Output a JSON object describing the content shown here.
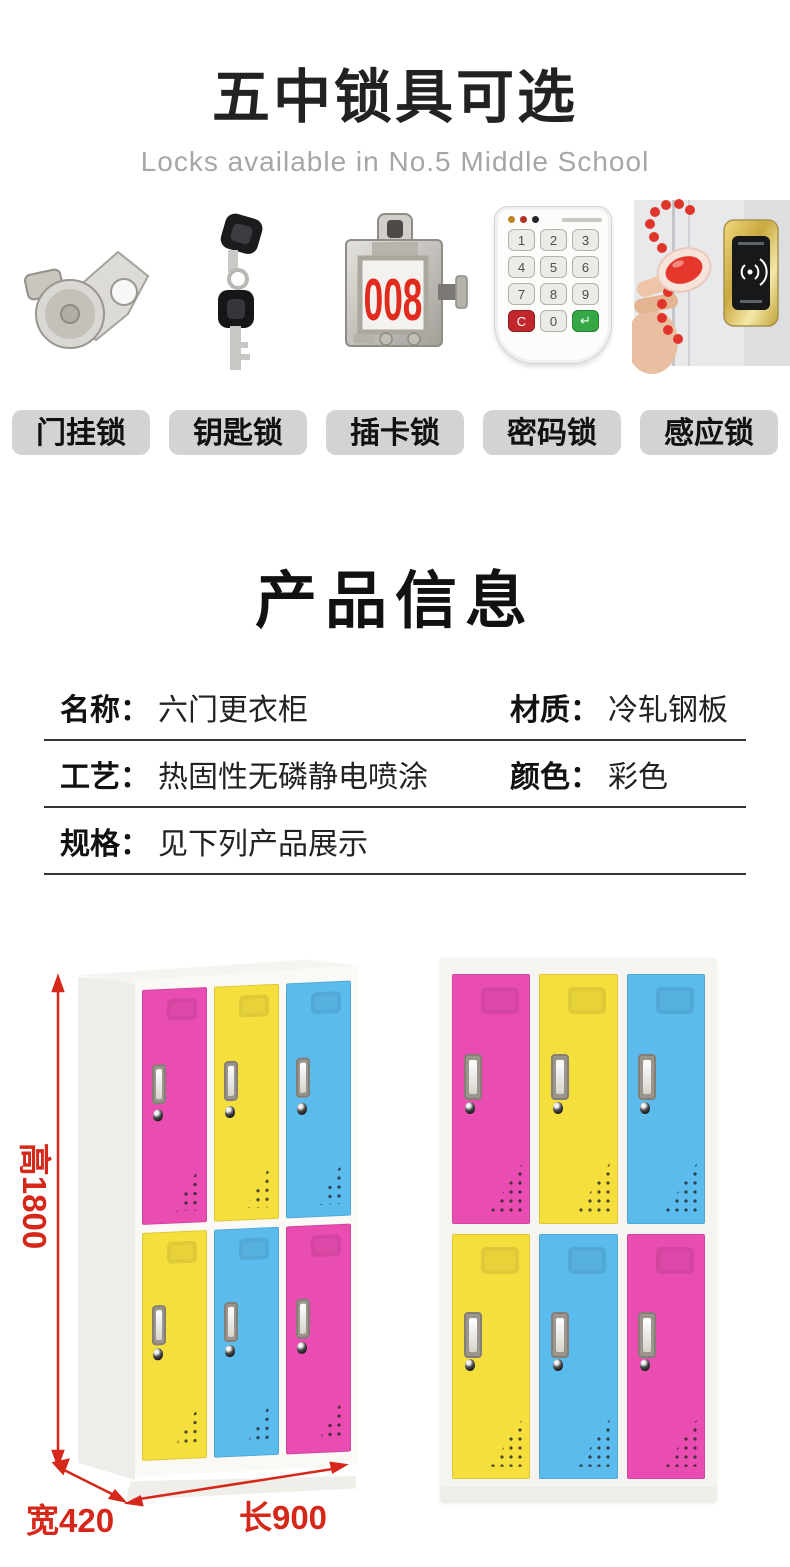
{
  "header": {
    "title": "五中锁具可选",
    "subtitle": "Locks available in No.5 Middle School"
  },
  "locks": {
    "card_number": "008",
    "keypad_keys": [
      "1",
      "2",
      "3",
      "4",
      "5",
      "6",
      "7",
      "8",
      "9",
      "C",
      "0",
      "↵"
    ],
    "items": [
      {
        "label": "门挂锁",
        "icon": "cam-latch-lock-icon"
      },
      {
        "label": "钥匙锁",
        "icon": "key-lock-icon"
      },
      {
        "label": "插卡锁",
        "icon": "card-lock-icon"
      },
      {
        "label": "密码锁",
        "icon": "keypad-lock-icon"
      },
      {
        "label": "感应锁",
        "icon": "induction-lock-icon"
      }
    ]
  },
  "product_info": {
    "heading": "产品信息",
    "fields": [
      {
        "label": "名称：",
        "value": "六门更衣柜"
      },
      {
        "label": "材质：",
        "value": "冷轧钢板"
      },
      {
        "label": "工艺：",
        "value": "热固性无磷静电喷涂"
      },
      {
        "label": "颜色：",
        "value": "彩色"
      },
      {
        "label": "规格：",
        "value": "见下列产品展示"
      }
    ]
  },
  "lockers": {
    "palette": {
      "pink": "#e94db1",
      "yellow": "#f5df3d",
      "blue": "#5bbbed"
    },
    "left": {
      "doors_top": [
        "pink",
        "yellow",
        "blue"
      ],
      "doors_bottom": [
        "yellow",
        "blue",
        "pink"
      ]
    },
    "right": {
      "doors_top": [
        "pink",
        "yellow",
        "blue"
      ],
      "doors_bottom": [
        "yellow",
        "blue",
        "pink"
      ]
    },
    "dimensions": {
      "height": "高1800",
      "width": "宽420",
      "length": "长900"
    },
    "dimension_color": "#d5281b"
  }
}
